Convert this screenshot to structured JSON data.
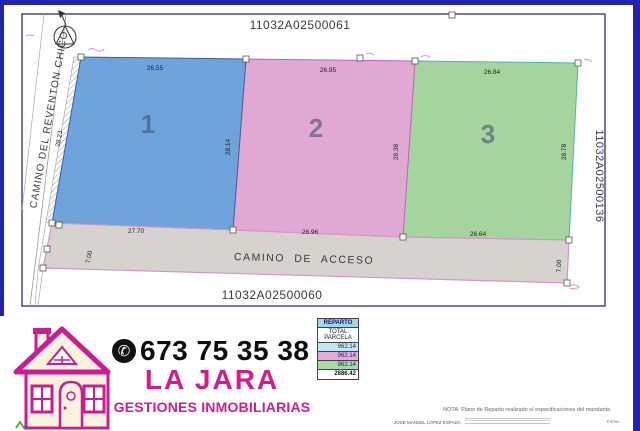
{
  "plan": {
    "ref_top": "11032A02500061",
    "ref_bottom": "11032A02500060",
    "ref_right": "11032A02500136",
    "street_left": "CAMINO DEL REVENTON CHICO",
    "access_road": {
      "label": "CAMINO DE ACCESO",
      "width_left": "7.00",
      "width_right": "7.00"
    },
    "parcels": [
      {
        "number": "1",
        "fill": "#6FA3DC",
        "dim_top": "26.55",
        "dim_left": "28.23",
        "dim_right": "28.14",
        "dim_bottom": "27.70"
      },
      {
        "number": "2",
        "fill": "#E0A9D3",
        "dim_top": "26.95",
        "dim_right": "28.38",
        "dim_bottom": "26.96"
      },
      {
        "number": "3",
        "fill": "#A5D49E",
        "dim_top": "26.84",
        "dim_right": "28.78",
        "dim_bottom": "26.64"
      }
    ]
  },
  "reparto": {
    "title": "REPARTO",
    "subtitle": "TOTAL PARCELA",
    "rows": [
      {
        "value": "962.14",
        "color": "#BFE9F2"
      },
      {
        "value": "962.14",
        "color": "#E8A8D8"
      },
      {
        "value": "962.14",
        "color": "#A8D8A8"
      }
    ],
    "total": "2886.42"
  },
  "note": "NOTA: Plano de Reparto realizado s/ especificaciones del mandante.",
  "fine_print": {
    "left": "JOSE MANUEL LOPEZ ESPADA",
    "right": "Firma:"
  },
  "brand": {
    "phone": "673 75 35 38",
    "phone_glyph": "✆",
    "name": "LA JARA",
    "tagline": "GESTIONES INMOBILIARIAS"
  },
  "colors": {
    "parcel_blue": "#6FA3DC",
    "parcel_pink": "#E0A9D3",
    "parcel_green": "#A5D49E",
    "road_gray": "#D6D2CE",
    "brand_magenta": "#D8188C",
    "scan_border_blue": "#2323AE"
  }
}
